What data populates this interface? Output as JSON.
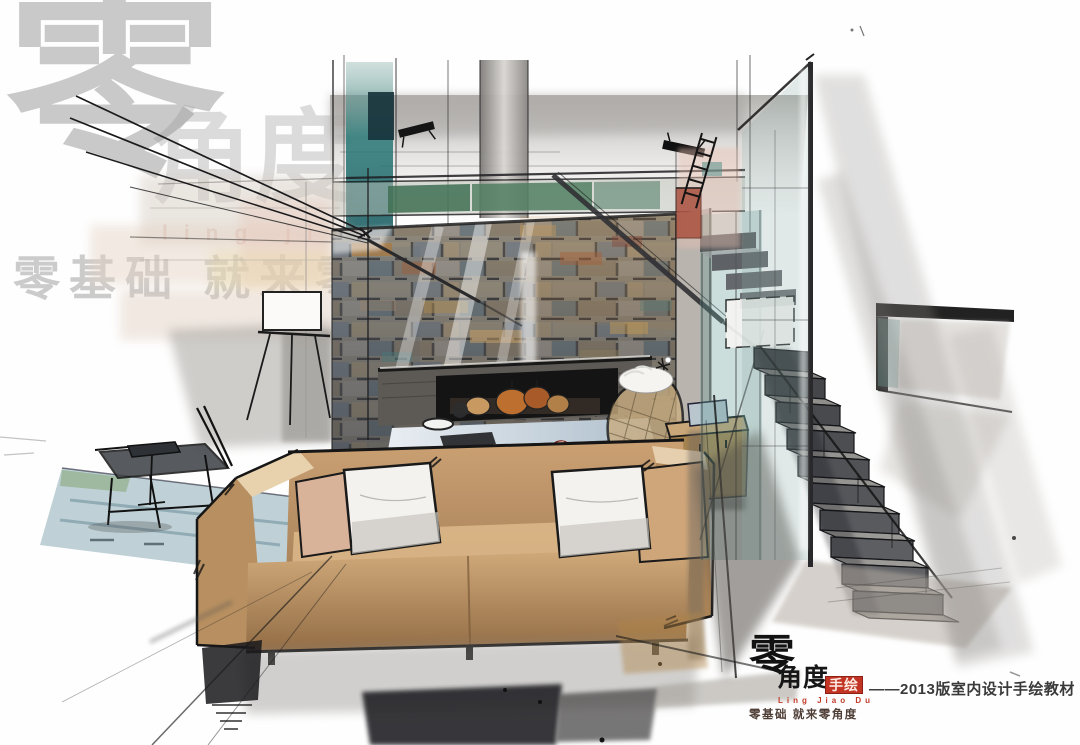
{
  "watermark": {
    "glyph_large": "零",
    "glyph_secondary": "角度",
    "pinyin": "ling jiao du",
    "tagline": "零基础 就来零角度"
  },
  "logo": {
    "glyph": "零",
    "brand": "角度",
    "brand_red": "手绘",
    "pinyin": "Ling Jiao Du",
    "slogan": "零基础  就来零角度",
    "caption": "——2013版室内设计手绘教材"
  },
  "palette": {
    "paper": "#fefefe",
    "ink": "#1a1a1a",
    "watermark_gray": "#9a9a9a",
    "logo_red": "#c23524",
    "sofa_tan": "#c69c6e",
    "sofa_shadow_tan": "#8f6a44",
    "pillow_white": "#f4f2ee",
    "stone_warm": "#8c8170",
    "stone_cool": "#6f7a7e",
    "glass_teal": "#2a7a78",
    "clerestory_green": "#4a7a5c",
    "accent_rust": "#a84a38",
    "apple_red": "#c03a24",
    "stair_dark": "#44464a",
    "wash_gray": "#b5b2ae",
    "floor_blue": "#7fa3b0"
  }
}
